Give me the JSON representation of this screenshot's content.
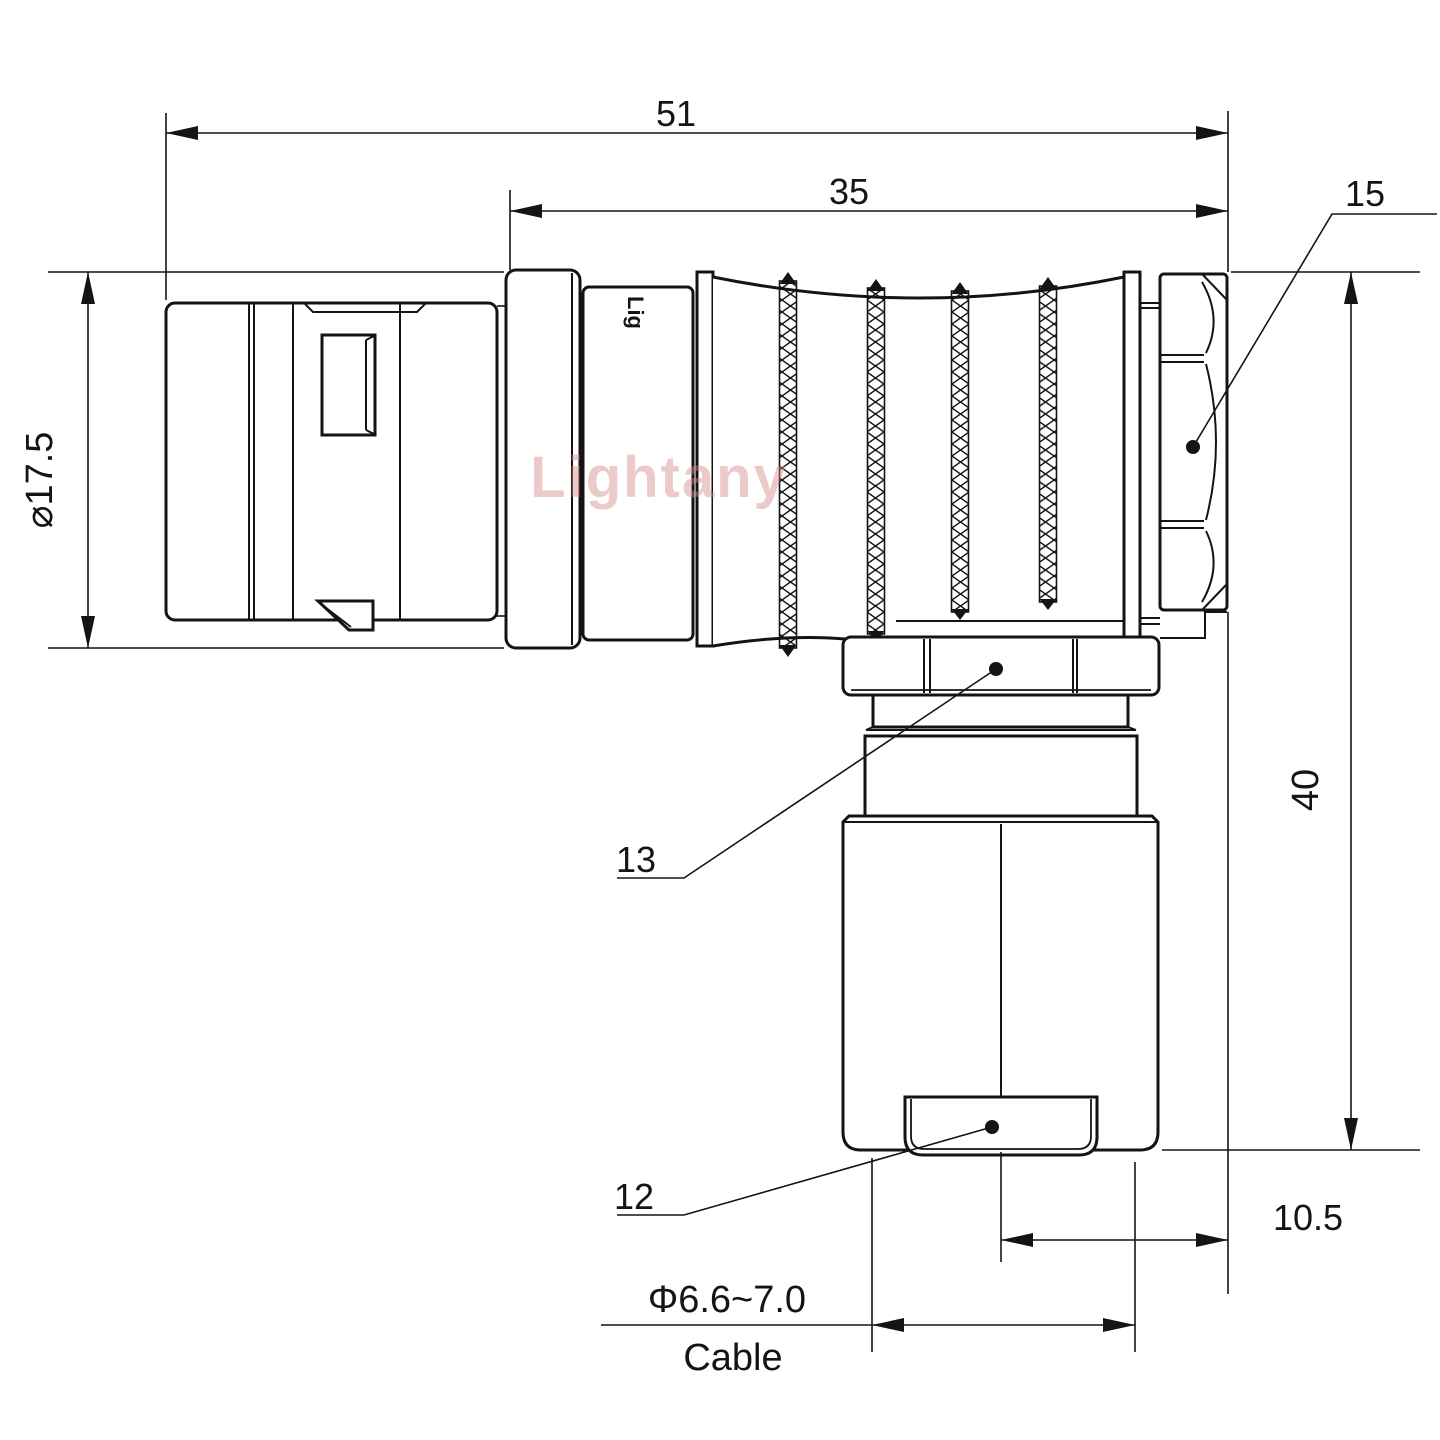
{
  "watermark": "Lightany",
  "body_marking": "Lig",
  "colors": {
    "line": "#141414",
    "watermark": "#d98c8c",
    "background": "#ffffff"
  },
  "dimensions": {
    "overall_length": "51",
    "shell_length": "35",
    "shell_diameter": "⌀17.5",
    "elbow_height": "40",
    "backnut_offset": "10.5",
    "cable_diameter": "Φ6.6~7.0",
    "cable_label": "Cable"
  },
  "part_labels": {
    "coupling_nut": "15",
    "gland_nut": "13",
    "cable_bush": "12"
  }
}
